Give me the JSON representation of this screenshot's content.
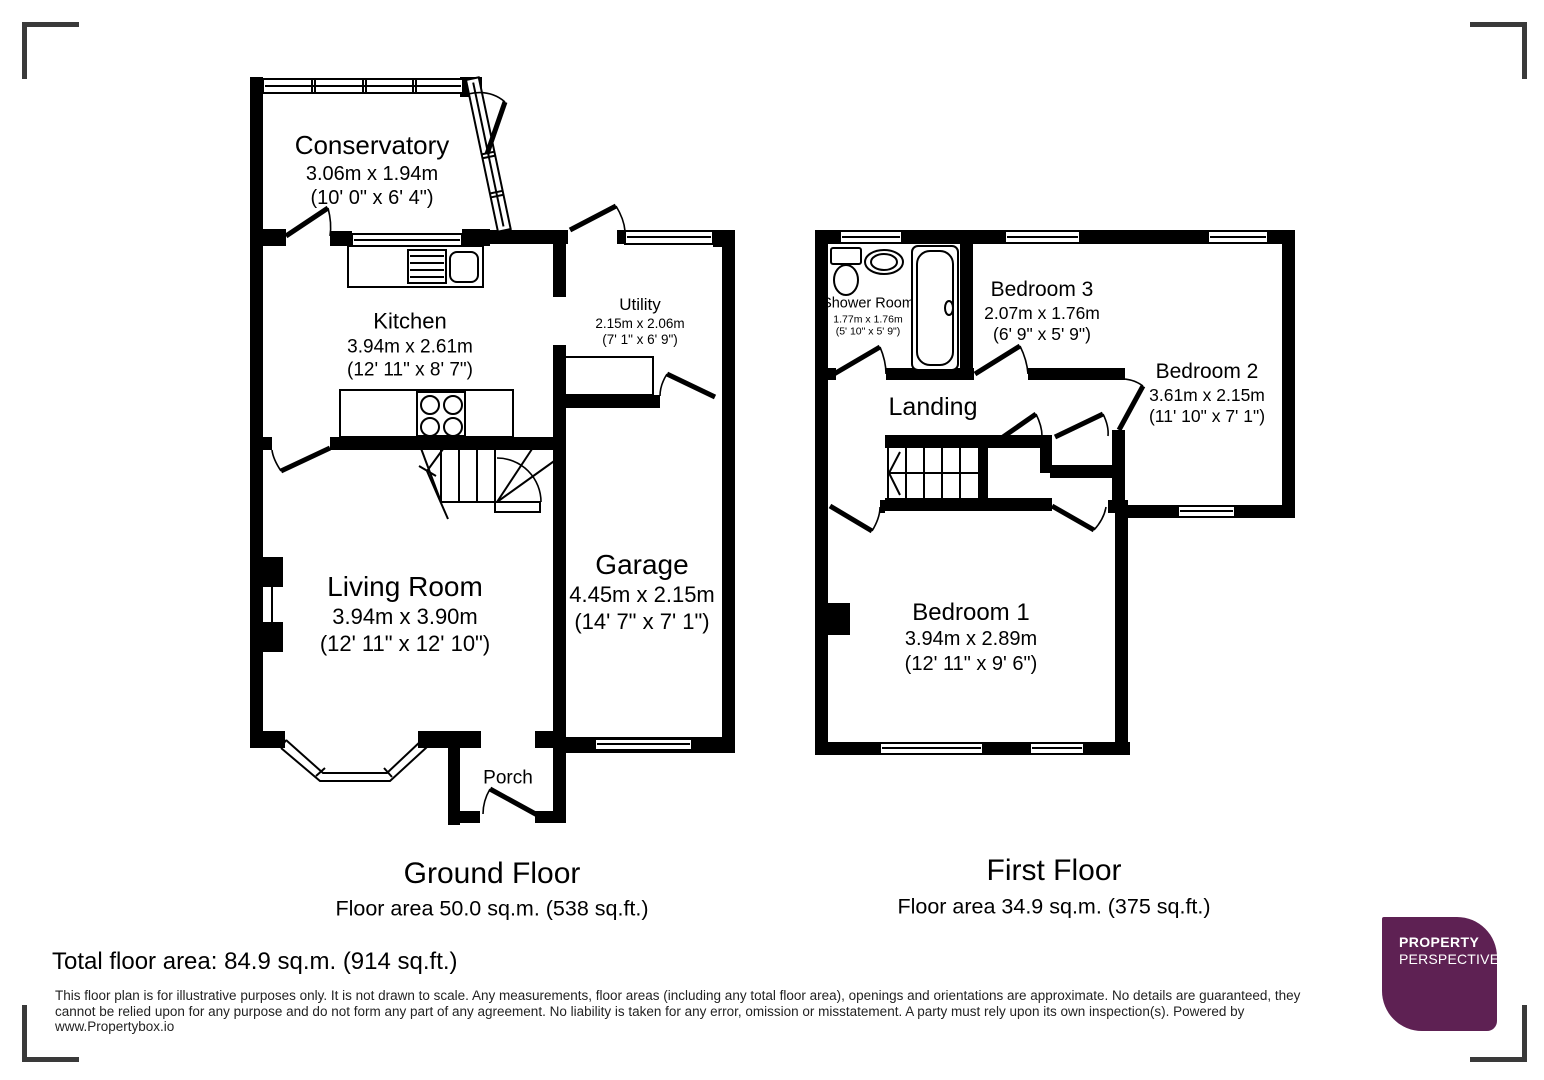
{
  "page": {
    "background": "#ffffff",
    "corner_mark_color": "#3a3a3a",
    "wall_color": "#000000"
  },
  "ground_floor": {
    "title": "Ground Floor",
    "area": "Floor area 50.0 sq.m. (538 sq.ft.)",
    "rooms": {
      "conservatory": {
        "name": "Conservatory",
        "metric": "3.06m x 1.94m",
        "imperial": "(10' 0\" x 6' 4\")"
      },
      "kitchen": {
        "name": "Kitchen",
        "metric": "3.94m x 2.61m",
        "imperial": "(12' 11\" x 8' 7\")"
      },
      "utility": {
        "name": "Utility",
        "metric": "2.15m x 2.06m",
        "imperial": "(7' 1\" x 6' 9\")"
      },
      "living_room": {
        "name": "Living Room",
        "metric": "3.94m x 3.90m",
        "imperial": "(12' 11\" x 12' 10\")"
      },
      "garage": {
        "name": "Garage",
        "metric": "4.45m x 2.15m",
        "imperial": "(14' 7\" x 7' 1\")"
      },
      "porch": {
        "name": "Porch"
      }
    }
  },
  "first_floor": {
    "title": "First Floor",
    "area": "Floor area 34.9 sq.m. (375 sq.ft.)",
    "rooms": {
      "shower_room": {
        "name": "Shower Room",
        "metric": "1.77m x 1.76m",
        "imperial": "(5' 10\" x 5' 9\")"
      },
      "bedroom3": {
        "name": "Bedroom 3",
        "metric": "2.07m x 1.76m",
        "imperial": "(6' 9\" x 5' 9\")"
      },
      "bedroom2": {
        "name": "Bedroom 2",
        "metric": "3.61m x 2.15m",
        "imperial": "(11' 10\" x 7' 1\")"
      },
      "landing": {
        "name": "Landing"
      },
      "bedroom1": {
        "name": "Bedroom 1",
        "metric": "3.94m x 2.89m",
        "imperial": "(12' 11\" x 9' 6\")"
      }
    }
  },
  "total_area": "Total floor area: 84.9 sq.m. (914 sq.ft.)",
  "disclaimer": "This floor plan is for illustrative purposes only. It is not drawn to scale. Any measurements, floor areas (including any total floor area), openings and orientations are approximate. No details are guaranteed, they cannot be relied upon for any purpose and do not form any part of any agreement. No liability is taken for any error, omission or misstatement. A party must rely upon its own inspection(s). Powered by www.Propertybox.io",
  "logo": {
    "line1": "PROPERTY",
    "line2": "PERSPECTIVE",
    "background": "#5e2153",
    "text_color": "#ffffff"
  }
}
